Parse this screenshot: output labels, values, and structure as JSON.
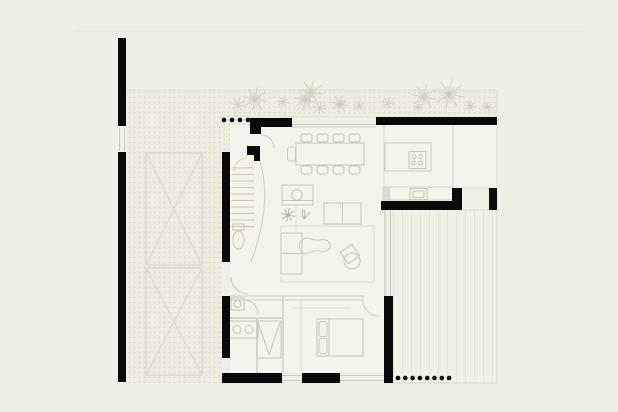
{
  "meta": {
    "title": "architectural-floor-plan",
    "canvas": {
      "w": 618,
      "h": 412
    },
    "description": "single-storey house floor plan with carport, entry court with trees, living-dining space, kitchen, bathroom, bedroom and rear deck"
  },
  "palette": {
    "background": "#f0efe6",
    "wall": "#0a0a0a",
    "furniture": "#c8c6b7",
    "partition": "#d0cebf",
    "faint": "#dfddce",
    "glass": "#cbc9ba",
    "tree": "#cfcdbe",
    "plant": "#a8a699",
    "cabinet_fill": "#dcdacb"
  },
  "regions": [
    {
      "name": "driveway-court",
      "x": 127,
      "y": 90,
      "w": 95,
      "h": 293,
      "pattern": "hatch"
    },
    {
      "name": "entry-court",
      "x": 222,
      "y": 90,
      "w": 275,
      "h": 27,
      "pattern": "hatch"
    },
    {
      "name": "entry-porch",
      "x": 222,
      "y": 117,
      "w": 30,
      "h": 36,
      "pattern": "hatch"
    },
    {
      "name": "interior-living",
      "x": 230,
      "y": 125,
      "w": 154,
      "h": 249,
      "pattern": "floor"
    },
    {
      "name": "interior-kitchen",
      "x": 384,
      "y": 125,
      "w": 69,
      "h": 76,
      "pattern": "floor"
    },
    {
      "name": "interior-store",
      "x": 453,
      "y": 125,
      "w": 44,
      "h": 63,
      "pattern": "floor"
    },
    {
      "name": "rear-deck",
      "x": 393,
      "y": 210,
      "w": 104,
      "h": 173,
      "pattern": "deck"
    },
    {
      "name": "side-passage",
      "x": 462,
      "y": 188,
      "w": 35,
      "h": 22,
      "pattern": "plain"
    }
  ],
  "walls": [
    {
      "name": "left-wall-upper",
      "x": 118,
      "y": 38,
      "w": 8,
      "h": 88
    },
    {
      "name": "left-wall-lower",
      "x": 118,
      "y": 152,
      "w": 8,
      "h": 230
    },
    {
      "name": "hall-wall-upper",
      "x": 222,
      "y": 152,
      "w": 8,
      "h": 110
    },
    {
      "name": "hall-wall-lower",
      "x": 222,
      "y": 296,
      "w": 8,
      "h": 62
    },
    {
      "name": "entry-wall",
      "x": 250,
      "y": 118,
      "w": 42,
      "h": 9
    },
    {
      "name": "entry-wall-stub",
      "x": 250,
      "y": 118,
      "w": 11,
      "h": 16
    },
    {
      "name": "entry-pier-a",
      "x": 247,
      "y": 146,
      "w": 13,
      "h": 9
    },
    {
      "name": "entry-pier-b",
      "x": 254,
      "y": 146,
      "w": 6,
      "h": 15
    },
    {
      "name": "north-wall-kitchen",
      "x": 376,
      "y": 117,
      "w": 121,
      "h": 8
    },
    {
      "name": "kitchen-south-wall",
      "x": 381,
      "y": 201,
      "w": 81,
      "h": 9
    },
    {
      "name": "kitchen-south-stub",
      "x": 452,
      "y": 188,
      "w": 10,
      "h": 14
    },
    {
      "name": "store-stub",
      "x": 489,
      "y": 188,
      "w": 8,
      "h": 22
    },
    {
      "name": "bedroom-east-wall",
      "x": 384,
      "y": 296,
      "w": 9,
      "h": 87
    },
    {
      "name": "south-wall-a",
      "x": 222,
      "y": 373,
      "w": 60,
      "h": 10
    },
    {
      "name": "south-wall-b",
      "x": 302,
      "y": 373,
      "w": 38,
      "h": 10
    }
  ],
  "boundaries": [
    {
      "name": "plot-line-top",
      "x1": 75,
      "y1": 31,
      "x2": 585,
      "y2": 31,
      "c": "#e6e4d7"
    },
    {
      "name": "court-top-edge",
      "x1": 127,
      "y1": 90,
      "x2": 497,
      "y2": 90,
      "c": "#dfddce"
    },
    {
      "name": "court-bottom-edge",
      "x1": 222,
      "y1": 117,
      "x2": 376,
      "y2": 117,
      "c": "#dfddce"
    },
    {
      "name": "plot-line-right",
      "x1": 497,
      "y1": 90,
      "x2": 497,
      "y2": 383,
      "c": "#dcdacb"
    },
    {
      "name": "deck-bottom-edge",
      "x1": 393,
      "y1": 383,
      "x2": 497,
      "y2": 383,
      "c": "#dcdacb"
    },
    {
      "name": "deck-top-edge",
      "x1": 462,
      "y1": 210,
      "x2": 497,
      "y2": 210,
      "c": "#dcdacb"
    },
    {
      "name": "store-threshold",
      "x1": 462,
      "y1": 188,
      "x2": 489,
      "y2": 188,
      "c": "#dcdacb"
    },
    {
      "name": "dining-window-a",
      "x1": 292,
      "y1": 124.5,
      "x2": 376,
      "y2": 124.5,
      "c": "#cbc9ba"
    },
    {
      "name": "dining-window-b",
      "x1": 292,
      "y1": 127,
      "x2": 376,
      "y2": 127,
      "c": "#cbc9ba"
    },
    {
      "name": "living-glass-a",
      "x1": 385,
      "y1": 210,
      "x2": 385,
      "y2": 296,
      "c": "#cbc9ba"
    },
    {
      "name": "living-glass-b",
      "x1": 390.5,
      "y1": 210,
      "x2": 390.5,
      "y2": 296,
      "c": "#cbc9ba"
    },
    {
      "name": "kitchen-divider",
      "x1": 384,
      "y1": 125,
      "x2": 384,
      "y2": 201,
      "c": "#dfddce"
    },
    {
      "name": "store-divider",
      "x1": 453,
      "y1": 125,
      "x2": 453,
      "y2": 187,
      "c": "#d7d5c6"
    },
    {
      "name": "left-gate-a",
      "x1": 119.5,
      "y1": 128,
      "x2": 119.5,
      "y2": 151,
      "c": "#cbc9ba"
    },
    {
      "name": "left-gate-b",
      "x1": 124.5,
      "y1": 128,
      "x2": 124.5,
      "y2": 151,
      "c": "#cbc9ba"
    },
    {
      "name": "south-window-a1",
      "x1": 282,
      "y1": 375.5,
      "x2": 302,
      "y2": 375.5,
      "c": "#cbc9ba"
    },
    {
      "name": "south-window-a2",
      "x1": 282,
      "y1": 380.5,
      "x2": 302,
      "y2": 380.5,
      "c": "#cbc9ba"
    },
    {
      "name": "south-window-b1",
      "x1": 340,
      "y1": 375.5,
      "x2": 384,
      "y2": 375.5,
      "c": "#cbc9ba"
    },
    {
      "name": "south-window-b2",
      "x1": 340,
      "y1": 380.5,
      "x2": 384,
      "y2": 380.5,
      "c": "#cbc9ba"
    }
  ],
  "furniture": [
    {
      "name": "carport-bay-1",
      "type": "xbox",
      "x": 146,
      "y": 153,
      "w": 56,
      "h": 112
    },
    {
      "name": "carport-bay-2",
      "type": "xbox",
      "x": 146,
      "y": 268,
      "w": 56,
      "h": 107
    },
    {
      "name": "stair-steps",
      "type": "steps",
      "x": 231.5,
      "y": 168,
      "w": 23,
      "n": 10,
      "gap": 6.5
    },
    {
      "name": "stair-curved-wall",
      "type": "path",
      "d": "M 259 158 C 268 186 267 218 251 262",
      "c": "#cfcdbe"
    },
    {
      "name": "entry-door-arc",
      "type": "path",
      "d": "M 261 135 A 13 13 0 0 1 274 148",
      "c": "#cfcdbe"
    },
    {
      "name": "entry-side-arc",
      "type": "path",
      "d": "M 247 158 A 13 13 0 0 0 234 171",
      "c": "#cfcdbe"
    },
    {
      "name": "powder-toilet-tank",
      "type": "rect",
      "x": 233,
      "y": 224,
      "w": 11,
      "h": 6
    },
    {
      "name": "powder-toilet-bowl",
      "type": "ellipse",
      "cx": 238.5,
      "cy": 240,
      "rx": 5.5,
      "ry": 9
    },
    {
      "name": "hall-door-arc",
      "type": "path",
      "d": "M 231 277 A 17 17 0 0 0 248 294",
      "c": "#cfcdbe"
    },
    {
      "name": "dining-table",
      "type": "rect",
      "x": 296,
      "y": 143,
      "w": 68,
      "h": 22
    },
    {
      "name": "dining-chair-1",
      "type": "rect",
      "x": 301,
      "y": 134,
      "w": 11,
      "h": 8,
      "rx": 2.5
    },
    {
      "name": "dining-chair-2",
      "type": "rect",
      "x": 317,
      "y": 134,
      "w": 11,
      "h": 8,
      "rx": 2.5
    },
    {
      "name": "dining-chair-3",
      "type": "rect",
      "x": 333,
      "y": 134,
      "w": 11,
      "h": 8,
      "rx": 2.5
    },
    {
      "name": "dining-chair-4",
      "type": "rect",
      "x": 349,
      "y": 134,
      "w": 11,
      "h": 8,
      "rx": 2.5
    },
    {
      "name": "dining-chair-5",
      "type": "rect",
      "x": 301,
      "y": 166,
      "w": 11,
      "h": 8,
      "rx": 2.5
    },
    {
      "name": "dining-chair-6",
      "type": "rect",
      "x": 317,
      "y": 166,
      "w": 11,
      "h": 8,
      "rx": 2.5
    },
    {
      "name": "dining-chair-7",
      "type": "rect",
      "x": 333,
      "y": 166,
      "w": 11,
      "h": 8,
      "rx": 2.5
    },
    {
      "name": "dining-chair-8",
      "type": "rect",
      "x": 349,
      "y": 166,
      "w": 11,
      "h": 8,
      "rx": 2.5
    },
    {
      "name": "dining-chair-end",
      "type": "rect",
      "x": 287.5,
      "y": 147,
      "w": 8,
      "h": 14,
      "rx": 2.5
    },
    {
      "name": "kitchen-island",
      "type": "rect",
      "x": 385,
      "y": 143,
      "w": 46,
      "h": 28
    },
    {
      "name": "cooktop-frame",
      "type": "rect",
      "x": 409,
      "y": 151.5,
      "w": 17,
      "h": 17
    },
    {
      "name": "cooktop-burner-1",
      "type": "circle",
      "cx": 414,
      "cy": 156.5,
      "r": 2
    },
    {
      "name": "cooktop-burner-2",
      "type": "circle",
      "cx": 420.5,
      "cy": 156.5,
      "r": 2
    },
    {
      "name": "cooktop-burner-3",
      "type": "circle",
      "cx": 414,
      "cy": 163,
      "r": 2
    },
    {
      "name": "cooktop-burner-4",
      "type": "circle",
      "cx": 420.5,
      "cy": 163,
      "r": 2
    },
    {
      "name": "kitchen-counter",
      "type": "rect",
      "x": 383,
      "y": 187,
      "w": 70,
      "h": 13,
      "c": "#d2d0c1"
    },
    {
      "name": "kitchen-cabinet",
      "type": "rect",
      "x": 383,
      "y": 187,
      "w": 7,
      "h": 13,
      "f": "#dcdacb",
      "c": "none"
    },
    {
      "name": "sink-outer",
      "type": "rect",
      "x": 410,
      "y": 188.5,
      "w": 17,
      "h": 11
    },
    {
      "name": "sink-inner",
      "type": "rect",
      "x": 413,
      "y": 191,
      "w": 11,
      "h": 6.5
    },
    {
      "name": "console-table",
      "type": "rect",
      "x": 282,
      "y": 185,
      "w": 31,
      "h": 20
    },
    {
      "name": "console-bowl",
      "type": "circle",
      "cx": 297,
      "cy": 195,
      "r": 5.2
    },
    {
      "name": "console-edge",
      "type": "line",
      "x1": 282,
      "y1": 200.5,
      "x2": 313,
      "y2": 200.5
    },
    {
      "name": "plant-star",
      "type": "tree",
      "x": 288,
      "y": 215,
      "r": 7,
      "c": "#a8a699"
    },
    {
      "name": "plant-sprout",
      "type": "path",
      "d": "M 304 219 q 2 -6 0 -9 M 304 219 q -3 -5 -1 -9 M 304 219 q 4 -4 6 -7",
      "c": "#b5b3a4"
    },
    {
      "name": "console-stand",
      "type": "line",
      "x1": 296,
      "y1": 205,
      "x2": 296,
      "y2": 233,
      "c": "#dedccf"
    },
    {
      "name": "rug-outline",
      "type": "rect",
      "x": 281,
      "y": 226,
      "w": 93,
      "h": 56,
      "c": "#e1dfd1"
    },
    {
      "name": "sofa-right",
      "type": "rect",
      "x": 324,
      "y": 203,
      "w": 37,
      "h": 21
    },
    {
      "name": "sofa-right-split",
      "type": "line",
      "x1": 342.5,
      "y1": 203,
      "x2": 342.5,
      "y2": 224
    },
    {
      "name": "sofa-left",
      "type": "rect",
      "x": 281,
      "y": 233,
      "w": 21,
      "h": 41
    },
    {
      "name": "sofa-left-split",
      "type": "line",
      "x1": 281,
      "y1": 253.5,
      "x2": 302,
      "y2": 253.5
    },
    {
      "name": "rug-blob",
      "type": "path",
      "d": "M 301 251 C 296 243 303 236 311 239 C 318 242 325 237 329 242 C 333 248 327 253 319 251 C 311 249 305 258 301 251 Z",
      "c": "#ccc9ba"
    },
    {
      "name": "armchair-seat",
      "type": "circle",
      "cx": 352,
      "cy": 261,
      "r": 8
    },
    {
      "name": "armchair-back",
      "type": "rect",
      "x": 343,
      "y": 247,
      "w": 14,
      "h": 14,
      "tr": "rotate(-35 350 254)"
    },
    {
      "name": "bath-partition-v1",
      "type": "line",
      "x1": 283,
      "y1": 296,
      "x2": 283,
      "y2": 373,
      "c": "#d0cebf",
      "sw": 1.5
    },
    {
      "name": "bath-partition-h",
      "type": "line",
      "x1": 230,
      "y1": 318,
      "x2": 283,
      "y2": 318,
      "c": "#d0cebf",
      "sw": 1.5
    },
    {
      "name": "bath-partition-v2",
      "type": "line",
      "x1": 257,
      "y1": 318,
      "x2": 257,
      "y2": 373,
      "c": "#d0cebf",
      "sw": 1.5
    },
    {
      "name": "bath-toilet",
      "type": "rect",
      "x": 231,
      "y": 298,
      "w": 13,
      "h": 12
    },
    {
      "name": "bath-toilet-bowl",
      "type": "circle",
      "cx": 237.5,
      "cy": 304,
      "r": 3.5
    },
    {
      "name": "bath-door-arc",
      "type": "path",
      "d": "M 244 300 A 14 14 0 0 1 258 314",
      "c": "#cfcdbe"
    },
    {
      "name": "vanity",
      "type": "rect",
      "x": 228,
      "y": 321,
      "w": 30,
      "h": 17
    },
    {
      "name": "vanity-sink-1",
      "type": "circle",
      "cx": 237,
      "cy": 329.5,
      "r": 4
    },
    {
      "name": "vanity-sink-2",
      "type": "circle",
      "cx": 249,
      "cy": 329.5,
      "r": 4
    },
    {
      "name": "shower-tray",
      "type": "rect",
      "x": 257,
      "y": 321,
      "w": 24,
      "h": 37
    },
    {
      "name": "shower-fall-1",
      "type": "line",
      "x1": 258,
      "y1": 322,
      "x2": 269,
      "y2": 355
    },
    {
      "name": "shower-fall-2",
      "type": "line",
      "x1": 280,
      "y1": 322,
      "x2": 269,
      "y2": 355
    },
    {
      "name": "bedroom-partition",
      "type": "rect",
      "x": 230,
      "y": 296,
      "w": 133,
      "h": 4,
      "c": "#d0cebf"
    },
    {
      "name": "bedroom-door-arc",
      "type": "path",
      "d": "M 363 300 A 16 16 0 0 0 379 316",
      "c": "#cfcdbe"
    },
    {
      "name": "bedroom-line",
      "type": "line",
      "x1": 301,
      "y1": 300,
      "x2": 301,
      "y2": 371,
      "c": "#dedccf"
    },
    {
      "name": "wardrobe-line",
      "type": "line",
      "x1": 292,
      "y1": 308,
      "x2": 350,
      "y2": 308,
      "c": "#dedccf"
    },
    {
      "name": "bed-frame",
      "type": "rect",
      "x": 317,
      "y": 319,
      "w": 46,
      "h": 37
    },
    {
      "name": "bed-pillow-1",
      "type": "rect",
      "x": 319,
      "y": 321.5,
      "w": 8,
      "h": 15,
      "rx": 2
    },
    {
      "name": "bed-pillow-2",
      "type": "rect",
      "x": 319,
      "y": 338.5,
      "w": 8,
      "h": 15,
      "rx": 2
    },
    {
      "name": "bed-head-line",
      "type": "line",
      "x1": 329,
      "y1": 319,
      "x2": 329,
      "y2": 356
    }
  ],
  "column_rows": [
    {
      "name": "entry-columns",
      "x": 224,
      "y": 120,
      "n": 4,
      "gap": 8,
      "r": 2.3
    },
    {
      "name": "terrace-columns",
      "x": 398,
      "y": 378,
      "n": 8,
      "gap": 7.3,
      "r": 2.3
    }
  ],
  "trees": [
    {
      "x": 238,
      "y": 105,
      "r": 7
    },
    {
      "x": 255,
      "y": 99,
      "r": 12
    },
    {
      "x": 283,
      "y": 102,
      "r": 6
    },
    {
      "x": 305,
      "y": 100,
      "r": 11
    },
    {
      "x": 311,
      "y": 92,
      "r": 12
    },
    {
      "x": 320,
      "y": 108,
      "r": 6
    },
    {
      "x": 340,
      "y": 104,
      "r": 9
    },
    {
      "x": 359,
      "y": 106,
      "r": 6
    },
    {
      "x": 388,
      "y": 103,
      "r": 6
    },
    {
      "x": 418,
      "y": 107,
      "r": 5
    },
    {
      "x": 424,
      "y": 97,
      "r": 13
    },
    {
      "x": 449,
      "y": 94,
      "r": 15
    },
    {
      "x": 470,
      "y": 106,
      "r": 6
    },
    {
      "x": 487,
      "y": 107,
      "r": 5
    }
  ]
}
